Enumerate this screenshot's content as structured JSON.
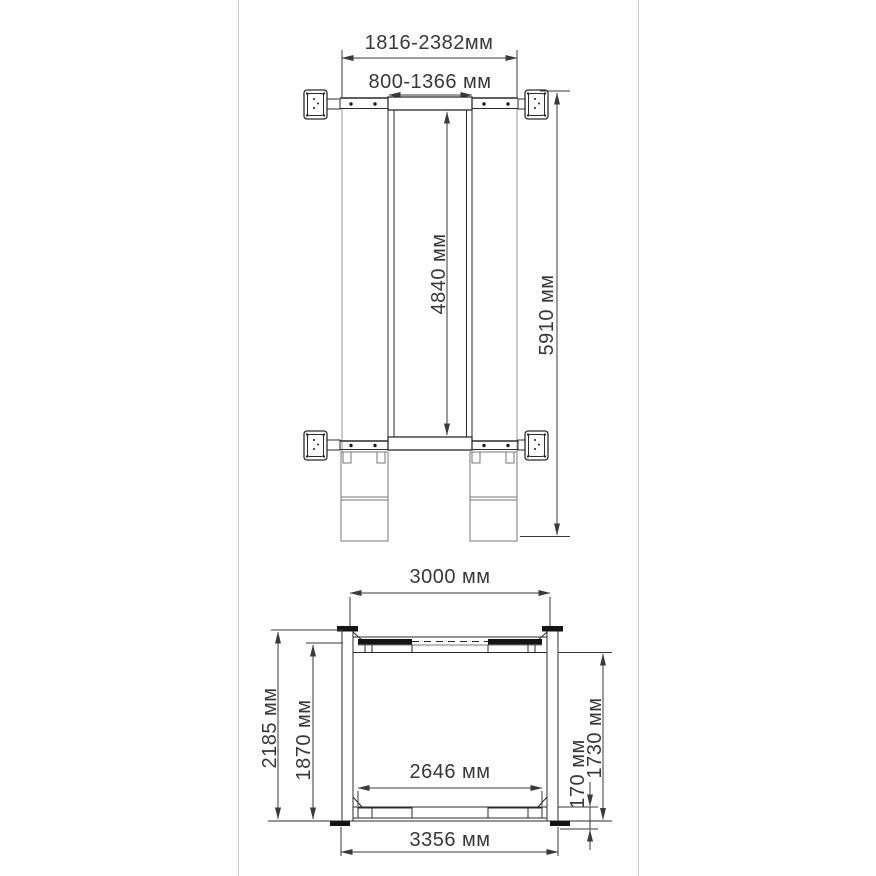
{
  "frame": {
    "background": "#ffffff",
    "border_color": "#cccccc"
  },
  "ink": {
    "line": "#2b2b2b",
    "dimension": "#3a3a3a",
    "text": "#383838",
    "light_edge": "#9a9a9a",
    "solid_fill": "#141414"
  },
  "top_view": {
    "dim_outer_width": "1816-2382мм",
    "dim_inner_width": "800-1366 мм",
    "dim_platform_length": "4840 мм",
    "dim_overall_length": "5910 мм"
  },
  "front_view": {
    "dim_posts_inner_width": "3000 мм",
    "dim_overall_height": "2185 мм",
    "dim_height_under_cap": "1870 мм",
    "dim_bottom_inner_width": "2646 мм",
    "dim_base_height": "170 мм",
    "dim_clear_height": "1730 мм",
    "dim_overall_width": "3356 мм"
  }
}
